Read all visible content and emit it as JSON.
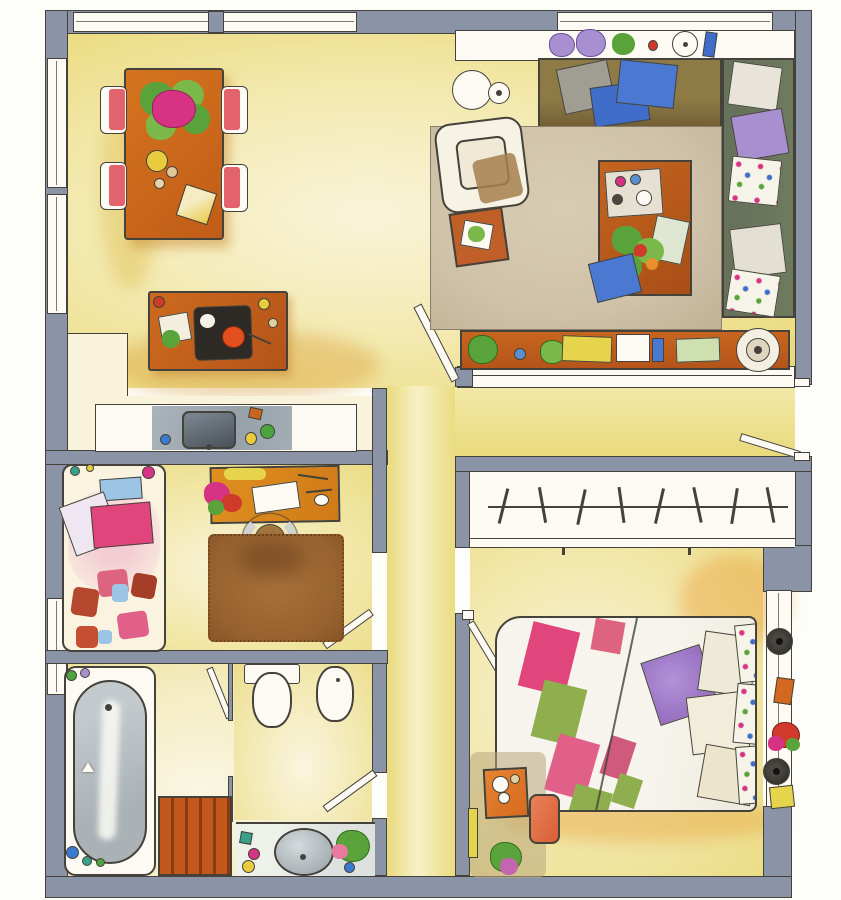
{
  "palette": {
    "paperWhite": "#fcfaf2",
    "ink": "#44423a",
    "wall": "#8b94a6",
    "floorYellow": "#eee08a",
    "floorDeep": "#e4d272",
    "floorCream": "#f8f3da",
    "terracotta": "#c8651f",
    "terracottaDark": "#b4541a",
    "woodOrange": "#dd8a1f",
    "rugBrown": "#9c6434",
    "rugBeige": "#cfc2a8",
    "sofaOlive": "#8d7a45",
    "sofaSeatBrown": "#6f5a33",
    "sofaGreen": "#6f7b5e",
    "cushionBlue": "#3f6dc9",
    "cushionGray": "#a09d92",
    "lilac": "#a88fd0",
    "chairPink": "#e2636e",
    "beddingPink": "#e0457b",
    "patchRed": "#b5472e",
    "quiltGreen": "#8fae4e",
    "tubGray": "#b5bdc1",
    "steelGray": "#9fa9b2",
    "sinkDark": "#586069",
    "deckOrange": "#c2581c",
    "deckDark": "#8a3c10",
    "plantGreen": "#5aa33a",
    "plantGreenLight": "#7bb84a",
    "flowerMagenta": "#d63384",
    "accentYellow": "#e6d44c",
    "accentRed": "#cf3a2a",
    "accentOrangeRed": "#e44f1f",
    "skyBlue": "#9cc4e4",
    "bookGreenPale": "#cfe0b0"
  },
  "plan": {
    "rooms": [
      {
        "name": "dining-area"
      },
      {
        "name": "living-room"
      },
      {
        "name": "kitchen"
      },
      {
        "name": "kids-room-office"
      },
      {
        "name": "bathroom"
      },
      {
        "name": "toilet-room"
      },
      {
        "name": "hallway"
      },
      {
        "name": "entrance-corridor"
      },
      {
        "name": "wardrobe-closet"
      },
      {
        "name": "bedroom"
      }
    ],
    "furniture": {
      "dining_area": [
        "dining-table",
        "dining-chair x4",
        "table-plant",
        "fruit-plate",
        "napkin",
        "kitchen-island",
        "cooktop",
        "kitchen-counter",
        "kitchen-sink"
      ],
      "living_room": [
        "windowsill-shelf",
        "potted-plants",
        "sofa-top",
        "sofa-right",
        "cushions",
        "armchair",
        "side-table",
        "round-table",
        "area-rug",
        "coffee-table",
        "flower-bouquet",
        "books",
        "sideboard",
        "record-player",
        "balcony-rail"
      ],
      "kids_room": [
        "single-bed",
        "pillows",
        "patch-blanket",
        "desk",
        "desk-chair",
        "shag-rug",
        "desk-flowers"
      ],
      "bathroom": [
        "bathtub",
        "shower-duckboard",
        "toilet",
        "bidet",
        "washbasin",
        "vanity",
        "vanity-plant"
      ],
      "wardrobe": [
        "hanger-rod",
        "clothes-hangers x8"
      ],
      "bedroom": [
        "double-bed",
        "patch-quilt",
        "purple-pillow",
        "cream-pillows",
        "floral-bolsters",
        "wall-lamp x2",
        "window-bench-book",
        "flower-pot",
        "dressing-table",
        "stool",
        "floor-plant"
      ]
    },
    "doors": [
      "living-room-door",
      "entrance-door",
      "bedroom-door",
      "kids-room-door",
      "bathroom-door",
      "toilet-door"
    ],
    "windows": [
      "top-left-window",
      "top-right-window",
      "left-window-upper",
      "left-window-lower",
      "kids-room-window",
      "bedroom-window"
    ]
  }
}
